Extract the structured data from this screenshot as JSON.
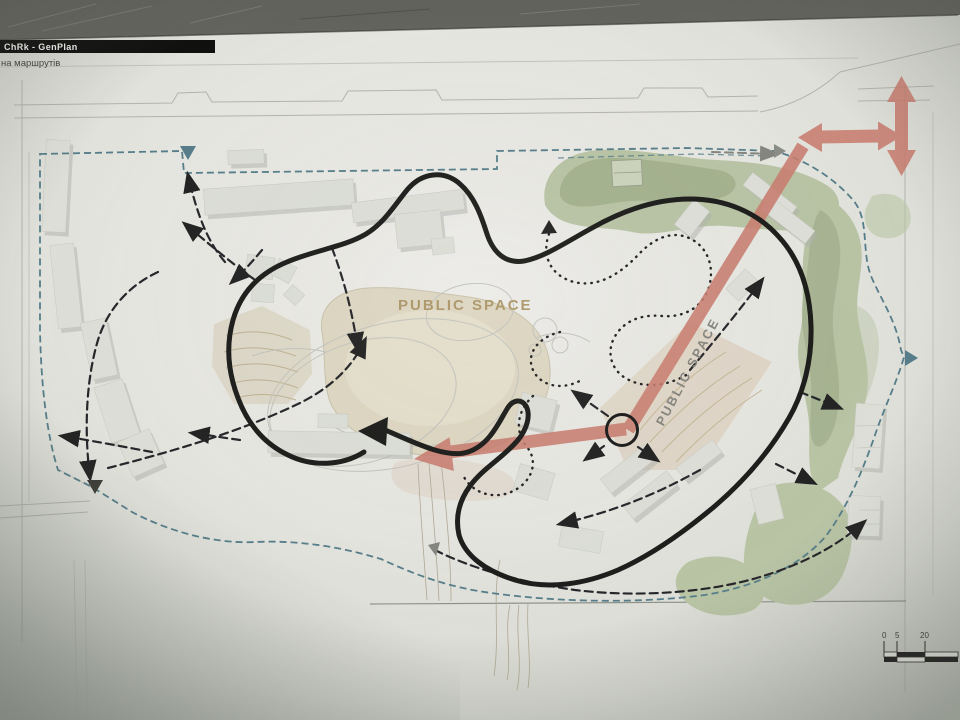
{
  "title_block": {
    "title": "ChRk - GenPlan",
    "subtitle": "на маршрутів"
  },
  "plan": {
    "public_space_label": "PUBLIC SPACE",
    "public_space_label_diagonal": "PUBLIC SPACE"
  },
  "scale_bar": {
    "ticks": [
      "0",
      "5",
      "20"
    ]
  },
  "markers": {
    "north_entrance": "down-triangle",
    "east_entrance": "right-triangle",
    "south_entrance": "down-triangle",
    "boundary_direction": "right-triangle"
  },
  "colors": {
    "accent_red": "#c87d6f",
    "green_light": "#b9c4a5",
    "green_dark": "#9dac88",
    "teal_boundary": "#567d89",
    "tan_plaza": "#ddd6c2",
    "route_black": "#1d1d1b",
    "paper": "#e7e7e2",
    "desk": "#6e6e68"
  }
}
